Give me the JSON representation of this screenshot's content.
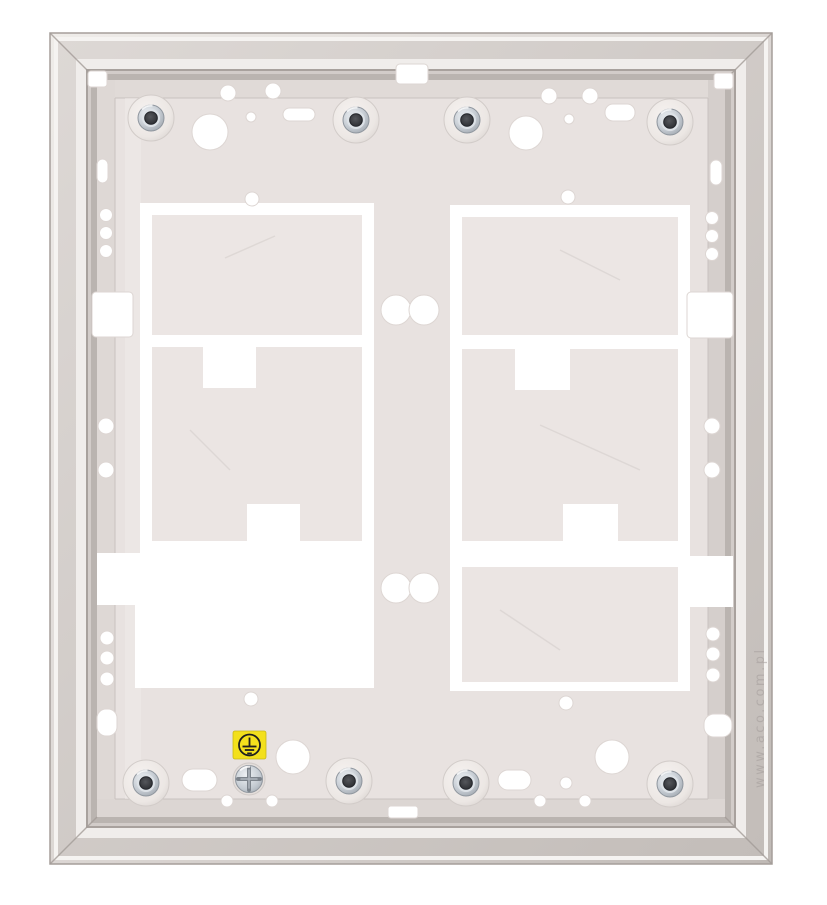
{
  "image": {
    "watermark_text": "www.aco.com.pl"
  },
  "ground_label": {
    "icon": "earth-ground-icon",
    "background_color": "#f3e01c",
    "symbol_color": "#1f1f1f"
  },
  "colors": {
    "page_background": "#ffffff",
    "bezel_bright": "#f5f3f1",
    "bezel_face": "#d5cfcc",
    "bezel_lip": "#a8a19d",
    "panel_face": "#e9e3e1",
    "knockout_plate": "#ece6e4",
    "cutout_white": "#ffffff",
    "standoff_metal": "#bac1c9",
    "standoff_hole": "#3e4045",
    "screw_metal": "#c2c9d1"
  },
  "hardware": {
    "standoff_count": 8,
    "knockout_count": 4,
    "earth_screw_count": 1
  }
}
